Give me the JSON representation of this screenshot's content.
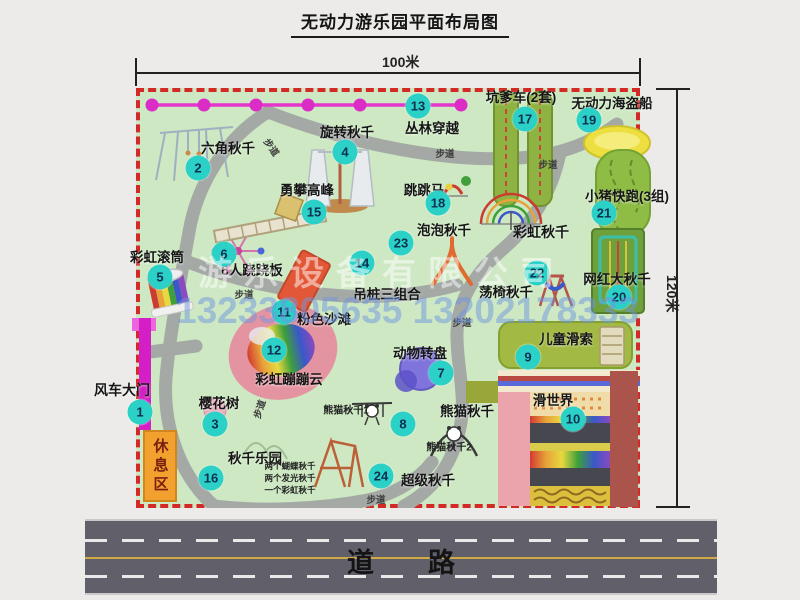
{
  "title": "无动力游乐园平面布局图",
  "dimensions": {
    "width_label": "100米",
    "height_label": "120米"
  },
  "road_label": "道　　路",
  "watermark": {
    "company": "游乐设备有限公司",
    "phone": "13233805635 13202178333"
  },
  "colors": {
    "map_bg": "#cde8c2",
    "border_red": "#d32a28",
    "marker_teal": "#2bd1c7",
    "path_gray": "#a4a9a6",
    "road_gray": "#615f69",
    "rope_pink": "#e02cc8",
    "rest_area_orange": "#f2a12e"
  },
  "rest_area_label": "休息区",
  "attractions": [
    {
      "num": "1",
      "name": "风车大门",
      "marker": [
        140,
        412
      ],
      "label": [
        122,
        390
      ],
      "size": 14
    },
    {
      "num": "2",
      "name": "六角秋千",
      "marker": [
        198,
        168
      ],
      "label": [
        228,
        147
      ]
    },
    {
      "num": "3",
      "name": "樱花树",
      "marker": [
        215,
        424
      ],
      "label": [
        219,
        402
      ]
    },
    {
      "num": "4",
      "name": "旋转秋千",
      "marker": [
        345,
        152
      ],
      "label": [
        347,
        131
      ]
    },
    {
      "num": "5",
      "name": "彩虹滚筒",
      "marker": [
        160,
        277
      ],
      "label": [
        157,
        256
      ]
    },
    {
      "num": "6",
      "name": "6人跷跷板",
      "marker": [
        224,
        254
      ],
      "label": [
        252,
        269
      ]
    },
    {
      "num": "7",
      "name": "动物转盘",
      "marker": [
        441,
        373
      ],
      "label": [
        420,
        352
      ]
    },
    {
      "num": "8",
      "name": "熊猫秋千",
      "marker": [
        403,
        424
      ],
      "label": [
        467,
        410
      ]
    },
    {
      "num": "9",
      "name": "儿童滑索",
      "marker": [
        528,
        357
      ],
      "label": [
        566,
        338
      ]
    },
    {
      "num": "10",
      "name": "滑世界",
      "marker": [
        573,
        419
      ],
      "label": [
        553,
        399
      ]
    },
    {
      "num": "11",
      "name": "粉色沙滩",
      "marker": [
        284,
        312
      ],
      "label": [
        324,
        318
      ]
    },
    {
      "num": "12",
      "name": "彩虹蹦蹦云",
      "marker": [
        274,
        350
      ],
      "label": [
        289,
        378
      ]
    },
    {
      "num": "13",
      "name": "丛林穿越",
      "marker": [
        418,
        106
      ],
      "label": [
        432,
        127
      ]
    },
    {
      "num": "14",
      "name": "吊桩三组合",
      "marker": [
        362,
        263
      ],
      "label": [
        387,
        293
      ]
    },
    {
      "num": "15",
      "name": "勇攀高峰",
      "marker": [
        314,
        212
      ],
      "label": [
        307,
        189
      ]
    },
    {
      "num": "16",
      "name": "秋千乐园",
      "marker": [
        211,
        478
      ],
      "label": [
        255,
        457
      ]
    },
    {
      "num": "17",
      "name": "坑爹车(2套)",
      "marker": [
        525,
        119
      ],
      "label": [
        521,
        96
      ]
    },
    {
      "num": "18",
      "name": "跳跳马",
      "marker": [
        438,
        203
      ],
      "label": [
        424,
        189
      ]
    },
    {
      "num": "19",
      "name": "无动力海盗船",
      "marker": [
        589,
        120
      ],
      "label": [
        612,
        102
      ]
    },
    {
      "num": "20",
      "name": "网红大秋千",
      "marker": [
        619,
        297
      ],
      "label": [
        617,
        278
      ]
    },
    {
      "num": "21",
      "name": "小猪快跑(3组)",
      "marker": [
        604,
        213
      ],
      "label": [
        627,
        195
      ]
    },
    {
      "num": "22",
      "name": "荡椅秋千",
      "marker": [
        537,
        273
      ],
      "label": [
        506,
        291
      ]
    },
    {
      "num": "23",
      "name": "泡泡秋千",
      "marker": [
        401,
        243
      ],
      "label": [
        444,
        229
      ]
    },
    {
      "num": "24",
      "name": "超级秋千",
      "marker": [
        381,
        476
      ],
      "label": [
        428,
        479
      ]
    }
  ],
  "extra_labels": [
    {
      "text": "彩虹秋千",
      "pos": [
        541,
        232
      ],
      "size": 14
    }
  ],
  "path_labels": [
    {
      "text": "步道",
      "pos": [
        272,
        147
      ],
      "rot": 55
    },
    {
      "text": "步道",
      "pos": [
        445,
        153
      ],
      "rot": 0
    },
    {
      "text": "步道",
      "pos": [
        548,
        164
      ],
      "rot": 0
    },
    {
      "text": "步道",
      "pos": [
        244,
        294
      ],
      "rot": 0
    },
    {
      "text": "步道",
      "pos": [
        462,
        322
      ],
      "rot": 0
    },
    {
      "text": "步道",
      "pos": [
        259,
        409
      ],
      "rot": -72
    },
    {
      "text": "步道",
      "pos": [
        376,
        499
      ],
      "rot": 0
    }
  ],
  "sub_labels": [
    {
      "text": "熊猫秋千1",
      "pos": [
        346,
        409
      ],
      "size": 10
    },
    {
      "text": "熊猫秋千2",
      "pos": [
        449,
        446
      ],
      "size": 10
    },
    {
      "text": "两个蝴蝶秋千",
      "pos": [
        290,
        466
      ],
      "size": 8.5
    },
    {
      "text": "两个发光秋千",
      "pos": [
        290,
        478
      ],
      "size": 8.5
    },
    {
      "text": "一个彩虹秋千",
      "pos": [
        290,
        490
      ],
      "size": 8.5
    }
  ]
}
